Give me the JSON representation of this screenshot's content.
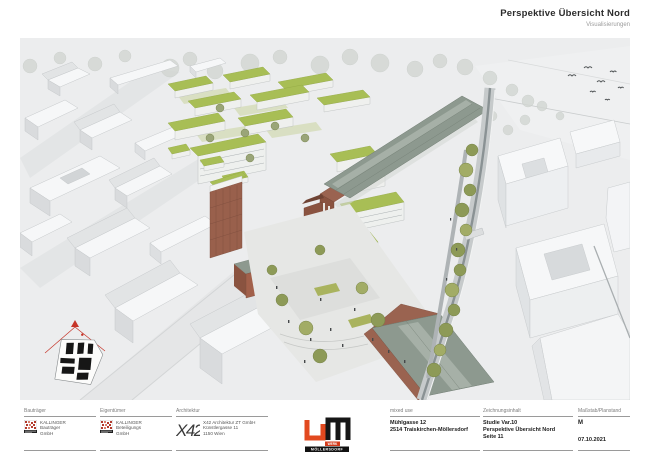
{
  "header": {
    "title": "Perspektive Übersicht Nord",
    "subtitle": "Visualisierungen"
  },
  "titleblock": {
    "developer": {
      "label": "Bauträger",
      "lines": [
        "KALLINGER",
        "Bauträger",
        "GmbH"
      ]
    },
    "owner": {
      "label": "Eigentümer",
      "lines": [
        "KALLINGER",
        "Beteiligungs",
        "GmbH"
      ]
    },
    "architect": {
      "label": "Architektur",
      "logo_text": "X42",
      "lines": [
        "X42 Architektur ZT GmbH",
        "Künstlergasse 11",
        "1150 Wien"
      ]
    },
    "brand": {
      "word1": "WERK",
      "word2": "MÖLLERSDORF"
    },
    "project": {
      "label": "mixed use",
      "lines": [
        "Mühlgasse 12",
        "2514 Traiskirchen-Möllersdorf"
      ]
    },
    "drawing": {
      "label": "Zeichnungsinhalt",
      "lines": [
        "Studie Var.10",
        "Perspektive Übersicht Nord",
        "Seite 11"
      ]
    },
    "scale": {
      "label": "Maßstab/Planstand",
      "scale": "M",
      "date": "07.10.2021"
    }
  },
  "palette": {
    "brand_orange": "#e2491f",
    "brand_black": "#161616",
    "kallinger_red": "#b23a2c",
    "green_roof": "#a8be55",
    "brick": "#9a6350",
    "hall_roof": "#8d998f",
    "north_key_red": "#c63428"
  }
}
